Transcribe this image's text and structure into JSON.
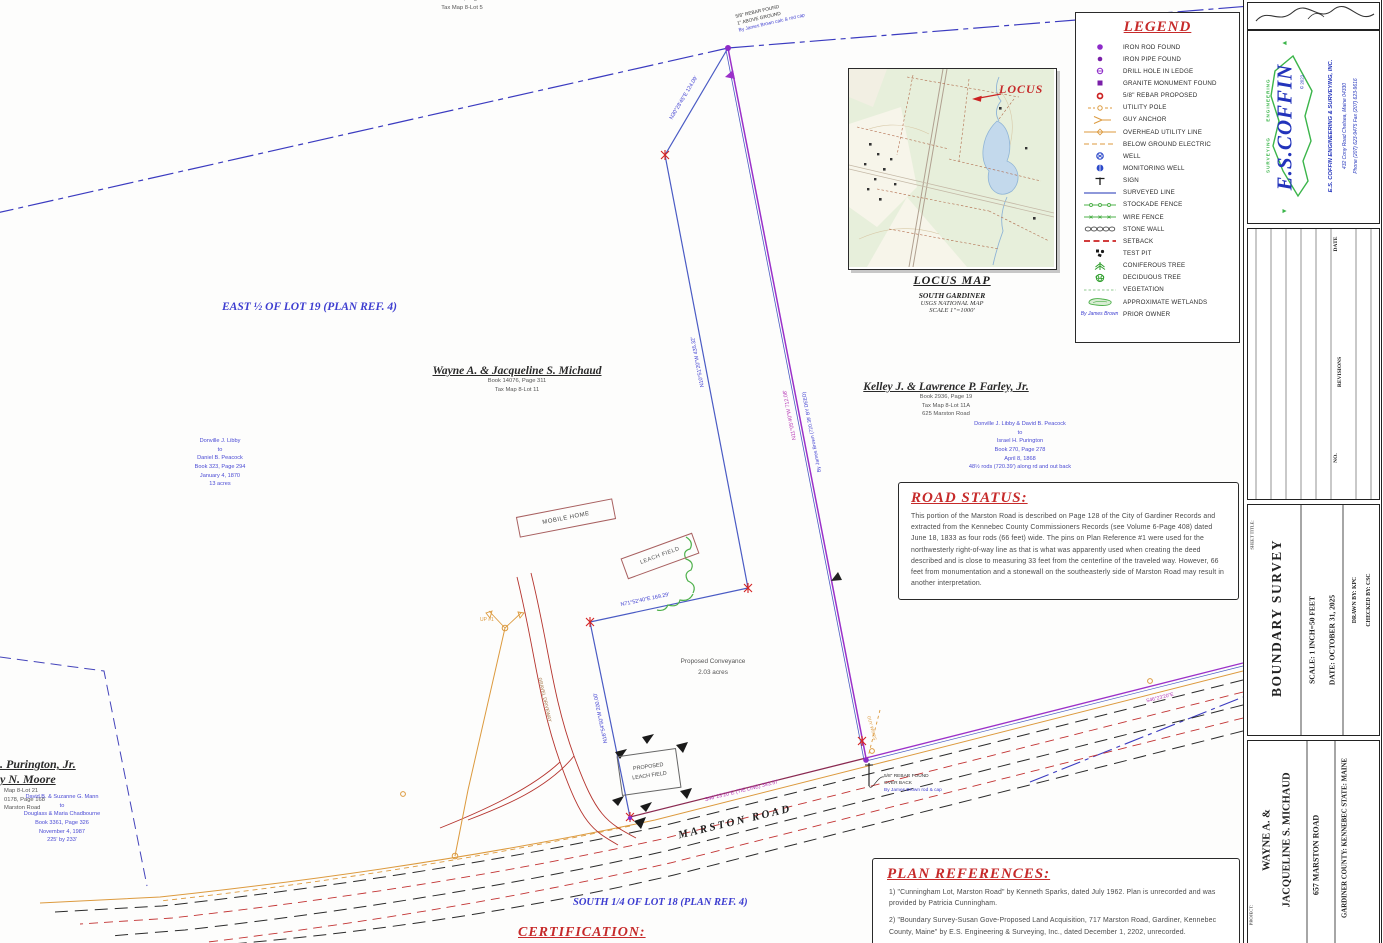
{
  "legend": {
    "title": "LEGEND",
    "items": [
      {
        "icon": "iron-rod-found-icon",
        "label": "IRON ROD FOUND"
      },
      {
        "icon": "iron-pipe-found-icon",
        "label": "IRON PIPE FOUND"
      },
      {
        "icon": "drill-hole-in-ledge-icon",
        "label": "DRILL HOLE IN LEDGE"
      },
      {
        "icon": "granite-monument-found-icon",
        "label": "GRANITE MONUMENT FOUND"
      },
      {
        "icon": "rebar-proposed-icon",
        "label": "5/8\" REBAR PROPOSED"
      },
      {
        "icon": "utility-pole-icon",
        "label": "UTILITY POLE"
      },
      {
        "icon": "guy-anchor-icon",
        "label": "GUY ANCHOR"
      },
      {
        "icon": "overhead-utility-line-icon",
        "label": "OVERHEAD UTILITY LINE"
      },
      {
        "icon": "below-ground-electric-icon",
        "label": "BELOW GROUND ELECTRIC"
      },
      {
        "icon": "well-icon",
        "label": "WELL"
      },
      {
        "icon": "monitoring-well-icon",
        "label": "MONITORING WELL"
      },
      {
        "icon": "sign-icon",
        "label": "SIGN"
      },
      {
        "icon": "surveyed-line-icon",
        "label": "SURVEYED LINE"
      },
      {
        "icon": "stockade-fence-icon",
        "label": "STOCKADE FENCE"
      },
      {
        "icon": "wire-fence-icon",
        "label": "WIRE FENCE"
      },
      {
        "icon": "stone-wall-icon",
        "label": "STONE WALL"
      },
      {
        "icon": "setback-icon",
        "label": "SETBACK"
      },
      {
        "icon": "test-pit-icon",
        "label": "TEST PIT"
      },
      {
        "icon": "coniferous-tree-icon",
        "label": "CONIFEROUS TREE"
      },
      {
        "icon": "deciduous-tree-icon",
        "label": "DECIDUOUS TREE"
      },
      {
        "icon": "vegetation-icon",
        "label": "VEGETATION"
      },
      {
        "icon": "approximate-wetlands-icon",
        "label": "APPROXIMATE WETLANDS"
      },
      {
        "icon": "prior-owner-icon",
        "label": "PRIOR OWNER",
        "symbol_text": "By James Brown"
      }
    ]
  },
  "locus": {
    "callout": "LOCUS",
    "title": "LOCUS MAP",
    "subtitle": "SOUTH GARDINER",
    "source": "USGS NATIONAL MAP",
    "scale": "SCALE 1\"=1000'"
  },
  "road_status": {
    "title": "ROAD STATUS:",
    "body": "This portion of the Marston Road is described on Page 128 of the City of Gardiner Records and extracted from the Kennebec County Commissioners Records (see Volume 6-Page 408) dated June 18, 1833 as four rods (66 feet) wide.  The pins on Plan Reference #1 were used for the northwesterly right-of-way line as that is what was apparently used when creating the deed described and is close to measuring 33 feet from the centerline of the traveled way.  However, 66 feet from monumentation and a stonewall on the southeasterly side of Marston Road may result in another interpretation."
  },
  "plan_references": {
    "title": "PLAN REFERENCES:",
    "item1": "1)  \"Cunningham Lot, Marston Road\" by Kenneth Sparks, dated July 1962.  Plan is unrecorded and was provided by Patricia Cunningham.",
    "item2": "2)  \"Boundary Survey-Susan Gove-Proposed Land Acquisition, 717 Marston Road, Gardiner, Kennebec County, Maine\" by E.S. Engineering & Surveying, Inc., dated December 1, 2202, unrecorded."
  },
  "certification": "CERTIFICATION:",
  "labels": {
    "east_lot": "EAST ½ OF LOT 19 (PLAN REF. 4)",
    "south_lot": "SOUTH 1/4 OF LOT 18 (PLAN REF. 4)",
    "road_name": "MARSTON ROAD",
    "mobile_home": "MOBILE HOME",
    "leach_field": "LEACH FIELD",
    "proposed_leach_1": "PROPOSED",
    "proposed_leach_2": "LEACH FIELD",
    "conveyance_1": "Proposed Conveyance",
    "conveyance_2": "2.03 acres",
    "driveway": "GRAVEL DRIVEWAY",
    "pole_tag": "UP #1",
    "guy": "GUY WIRES"
  },
  "owners": {
    "michaud": {
      "name": "Wayne A. & Jacqueline S. Michaud",
      "book": "Book 14076, Page 311",
      "tax": "Tax Map 8-Lot 11"
    },
    "farley": {
      "name": "Kelley J. & Lawrence P. Farley, Jr.",
      "book": "Book 2936, Page 19",
      "tax": "Tax Map 8-Lot 11A",
      "addr": "625 Marston Road"
    },
    "purington": {
      "line1": ". Purington, Jr.",
      "line2": "y N. Moore",
      "line3": "Map 8-Lot 21",
      "line4": "0178, Page 168",
      "line5": "Marston Road"
    },
    "top_cut": {
      "line1": "Book 12625, Page 331",
      "line2": "Tax Map 8-Lot 5"
    }
  },
  "deeds": {
    "left": [
      "Donville J. Libby",
      "to",
      "Daniel B. Peacock",
      "Book 323, Page 294",
      "January 4, 1870",
      "13 acres"
    ],
    "right": [
      "Donville J. Libby & David B. Peacock",
      "to",
      "Israel H. Purington",
      "Book 270, Page 278",
      "April 8, 1868",
      "48½ rods (720.39') along rd and out back"
    ],
    "bottom_left": [
      "David B. & Suzanne G. Mann",
      "to",
      "Douglass & Maria Chadbourne",
      "Book 3361, Page 326",
      "November 4, 1987",
      "225' by 233'"
    ]
  },
  "bearings": {
    "b1": "N30°28'45\"E  124.09'",
    "b2": "N10°51'20\"W  435.32'",
    "b3": "N71°52'40\"E  169.29'",
    "b4": "N16°54'50\"W  200.00'",
    "b5": "S46°23'20\"E   (TIE LINE)   343.57'",
    "b6": "N11°05'40\"W  712.08'",
    "b7": "By James Brown (720.39' BY DEED)",
    "b8": "S46°23'20\"E"
  },
  "monument_notes": {
    "top1": "5/8\" REBAR FOUND",
    "top2": "1\" ABOVE GROUND",
    "top3": "By James Brown calc & rod cap",
    "bot1": "5/8\" REBAR FOUND",
    "bot2": "OVER BACK",
    "bot3": "By James Brown rod & cap"
  },
  "title_block": {
    "company": {
      "name_big": "E.S.COFFIN",
      "eng": "ENGINEERING",
      "surv": "SURVEYING",
      "copyright": "© 2023",
      "inc": "E.S. COFFIN ENGINEERING & SURVEYING, INC.",
      "address": "432 Cony Road   Chelsea, Maine 04330",
      "phone": "Phone (207) 623-9475    Fax (207) 623-9616"
    },
    "revisions": {
      "date": "DATE",
      "revisions": "REVISIONS",
      "no": "NO."
    },
    "sheet": {
      "label": "SHEET TITLE:",
      "title": "BOUNDARY SURVEY",
      "scale": "SCALE:   1 INCH=50 FEET",
      "date": "DATE:   OCTOBER 31, 2025",
      "drawn": "DRAWN BY:   KPC",
      "checked": "CHECKED BY:   CSC"
    },
    "project": {
      "label": "PROJECT:",
      "name1": "WAYNE A. &",
      "name2": "JACQUELINE S. MICHAUD",
      "address": "657 MARSTON ROAD",
      "citystate": "GARDINER      COUNTY:  KENNEBEC      STATE:  MAINE"
    }
  }
}
